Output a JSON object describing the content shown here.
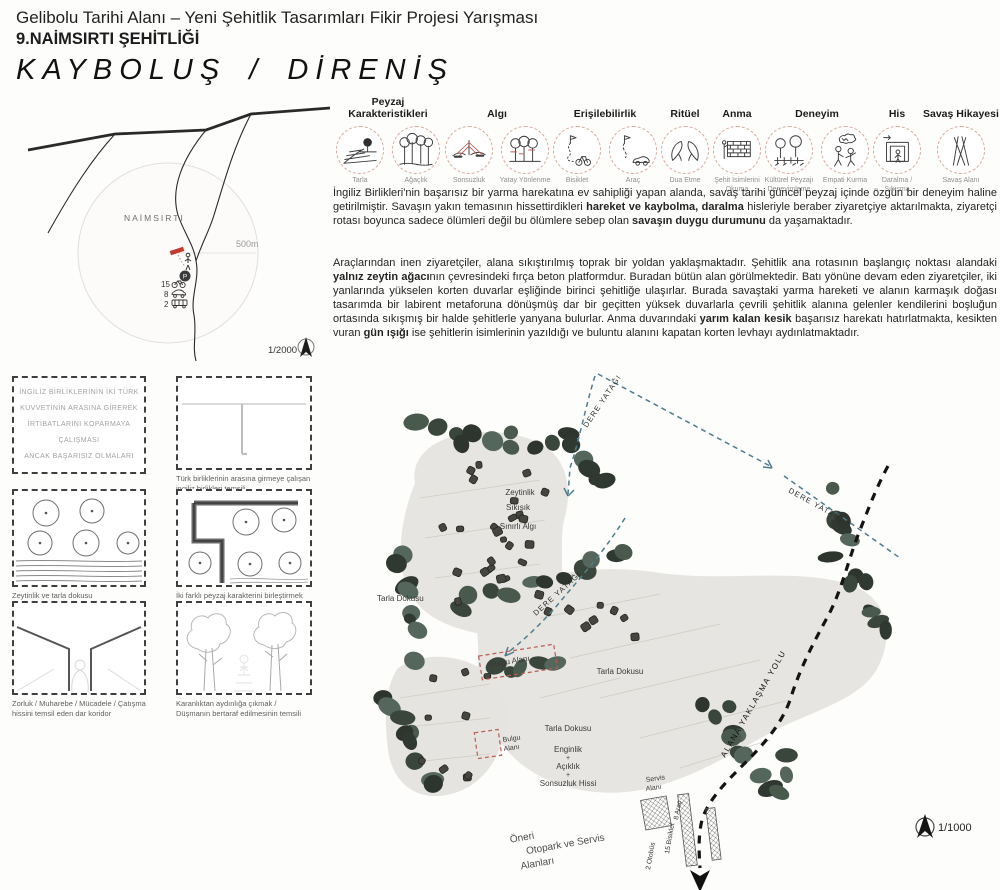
{
  "header": {
    "competition_title": "Gelibolu Tarihi Alanı – Yeni Şehitlik Tasarımları Fikir Projesi Yarışması",
    "board_title": "9.NAİMSIRTI ŞEHİTLİĞİ",
    "concept_title": "KAYBOLUŞ / DİRENİŞ"
  },
  "concepts": [
    {
      "label": "Peyzaj Karakteristikleri",
      "icons": [
        {
          "icon": "field",
          "caption": "Tarla"
        },
        {
          "icon": "woods",
          "caption": "Ağaçlık"
        }
      ]
    },
    {
      "label": "Algı",
      "icons": [
        {
          "icon": "infinity",
          "caption": "Sonsuzluk"
        },
        {
          "icon": "horizontal",
          "caption": "Yatay Yönlenme"
        }
      ]
    },
    {
      "label": "Erişilebilirlik",
      "icons": [
        {
          "icon": "bike-route",
          "caption": "Bisiklet"
        },
        {
          "icon": "car-route",
          "caption": "Araç"
        }
      ]
    },
    {
      "label": "Ritüel",
      "icons": [
        {
          "icon": "pray",
          "caption": "Dua Etme"
        }
      ]
    },
    {
      "label": "Anma",
      "icons": [
        {
          "icon": "wall",
          "caption": "Şehit İsimlerini Okuma"
        }
      ]
    },
    {
      "label": "Deneyim",
      "icons": [
        {
          "icon": "landscape",
          "caption": "Kültürel Peyzajı Deneyimleme"
        },
        {
          "icon": "empathy",
          "caption": "Empati Kurma"
        }
      ]
    },
    {
      "label": "His",
      "icons": [
        {
          "icon": "squeeze",
          "caption": "Daralma / Sıkışma"
        }
      ]
    },
    {
      "label": "Savaş Hikayesi",
      "icons": [
        {
          "icon": "battlefield",
          "caption": "Savaş Alanı"
        }
      ]
    }
  ],
  "paragraphs": {
    "p1": [
      {
        "t": "İngiliz Birlikleri'nin başarısız bir yarma harekatına ev sahipliği yapan alanda, savaş tarihi güncel peyzaj içinde özgün bir deneyim haline getirilmiştir. Savaşın yakın temasının hissettirdikleri ",
        "b": false
      },
      {
        "t": "hareket ve kaybolma, daralma",
        "b": true
      },
      {
        "t": " hisleriyle beraber ziyaretçiye aktarılmakta, ziyaretçi rotası boyunca sadece ölümleri değil bu ölümlere sebep olan ",
        "b": false
      },
      {
        "t": "savaşın duygu durumunu",
        "b": true
      },
      {
        "t": " da yaşamaktadır.",
        "b": false
      }
    ],
    "p2": [
      {
        "t": "Araçlarından inen ziyaretçiler, alana sıkıştırılmış toprak bir yoldan yaklaşmaktadır. Şehitlik ana rotasının başlangıç noktası alandaki ",
        "b": false
      },
      {
        "t": "yalnız zeytin ağacı",
        "b": true
      },
      {
        "t": "nın çevresindeki fırça beton platformdur. Buradan bütün alan görülmektedir. Batı yönüne devam eden ziyaretçiler, iki yanlarında yükselen korten duvarlar eşliğinde birinci şehitliğe ulaşırlar. Burada savaştaki yarma hareketi ve alanın karmaşık doğası tasarımda bir labirent metaforuna dönüşmüş dar bir geçitten yüksek duvarlarla çevrili şehitlik alanına gelenler kendilerini boşluğun ortasında sıkışmış bir halde şehitlerle yanyana bulurlar. Anma duvarındaki ",
        "b": false
      },
      {
        "t": "yarım kalan kesik",
        "b": true
      },
      {
        "t": " başarısız harekatı hatırlatmakta, kesikten vuran ",
        "b": false
      },
      {
        "t": "gün ışığı",
        "b": true
      },
      {
        "t": " ise şehitlerin isimlerinin yazıldığı ve buluntu alanını kapatan korten levhayı aydınlatmaktadır.",
        "b": false
      }
    ]
  },
  "location_map": {
    "place_label": "NAİMSIRTI",
    "radius_label": "500m",
    "scale_label": "1/2000",
    "parking_letter": "P",
    "capacities": [
      {
        "count": "15",
        "vehicle": "bicycle"
      },
      {
        "count": "8",
        "vehicle": "car"
      },
      {
        "count": "2",
        "vehicle": "bus"
      }
    ]
  },
  "sketches": [
    {
      "lines": [
        "İNGİLİZ BİRLİKLERİNİN İKİ TÜRK",
        "KUVVETİNİN ARASINA GİREREK",
        "İRTİBATLARINI KOPARMAYA ÇALIŞMASI",
        "ANCAK BAŞARISIZ OLMALARI"
      ],
      "caption": ""
    },
    {
      "caption": "Türk birliklerinin arasına girmeye çalışan ingiliz birlikleri temsili"
    },
    {
      "caption": "Zeytinlik ve tarla dokusu"
    },
    {
      "caption": "İki farklı peyzaj karakterini birleştirmek"
    },
    {
      "caption": "Zorluk / Muharebe / Mücadele / Çatışma hissini temsil eden dar koridor"
    },
    {
      "caption": "Karanlıktan aydınlığa çıkmak / Düşmanın bertaraf edilmesinin temsili"
    }
  ],
  "site_plan": {
    "scale_label": "1/1000",
    "labels": {
      "stream": "DERE YATAĞI",
      "approach_road": "ALANA YAKLAŞMA YOLU",
      "olive_stack": [
        "Zeytinlik",
        "Sıkışık",
        "+",
        "Sınırlı Algı"
      ],
      "field_texture": "Tarla Dokusu",
      "field_stack": [
        "Tarla Dokusu",
        "Enginlik",
        "+",
        "Açıklık",
        "+",
        "Sonsuzluk Hissi"
      ],
      "finding_area": "Bulgu Alanı",
      "finding_area_lines": [
        "Bulgu",
        "Alanı"
      ],
      "service_area_lines": [
        "Servis",
        "Alanı"
      ],
      "parking_note_lines": [
        "Öneri",
        "Otopark ve Servis",
        "Alanları"
      ],
      "capacity_labels": [
        "8 Araç",
        "15 Bisiklet",
        "2 Otobüs"
      ]
    },
    "colors": {
      "stream": "#4f7d8e",
      "tree_dark": "#2e352e",
      "terrain": "#e7e5e1",
      "marker_red": "#c33b2e"
    }
  }
}
